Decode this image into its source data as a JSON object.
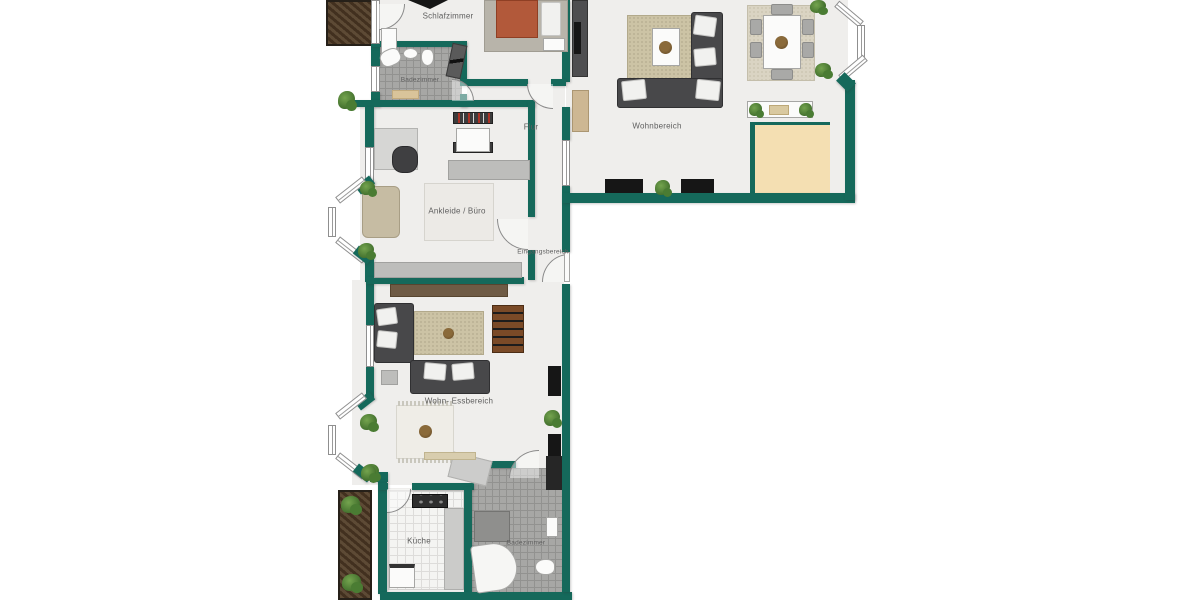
{
  "plan": {
    "type": "floor-plan",
    "language": "de",
    "style": "2D color architectural plan, teal walls, top-down furniture"
  },
  "rooms": {
    "schlafzimmer": {
      "label": "Schlafzimmer"
    },
    "badezimmer_oben": {
      "label": "Badezimmer"
    },
    "flur": {
      "label": "Flur"
    },
    "wohnbereich": {
      "label": "Wohnbereich"
    },
    "ankleide_buero": {
      "label": "Ankleide / Büro"
    },
    "eingangsbereich": {
      "label": "Eingangsbereich"
    },
    "wohn_essbereich": {
      "label": "Wohn- Essbereich"
    },
    "kueche": {
      "label": "Küche"
    },
    "badezimmer_unten": {
      "label": "Badezimmer"
    }
  },
  "colors": {
    "wall": "#15695b",
    "floor": "#efeeec",
    "terrace": "#f4dfb2",
    "rug": "#ccc3a5",
    "sofa": "#48484a",
    "bed": "#b2593a",
    "deck_wood": "#5d4a35",
    "plant": "#4a7c33",
    "tile": "#a7a7a5"
  }
}
